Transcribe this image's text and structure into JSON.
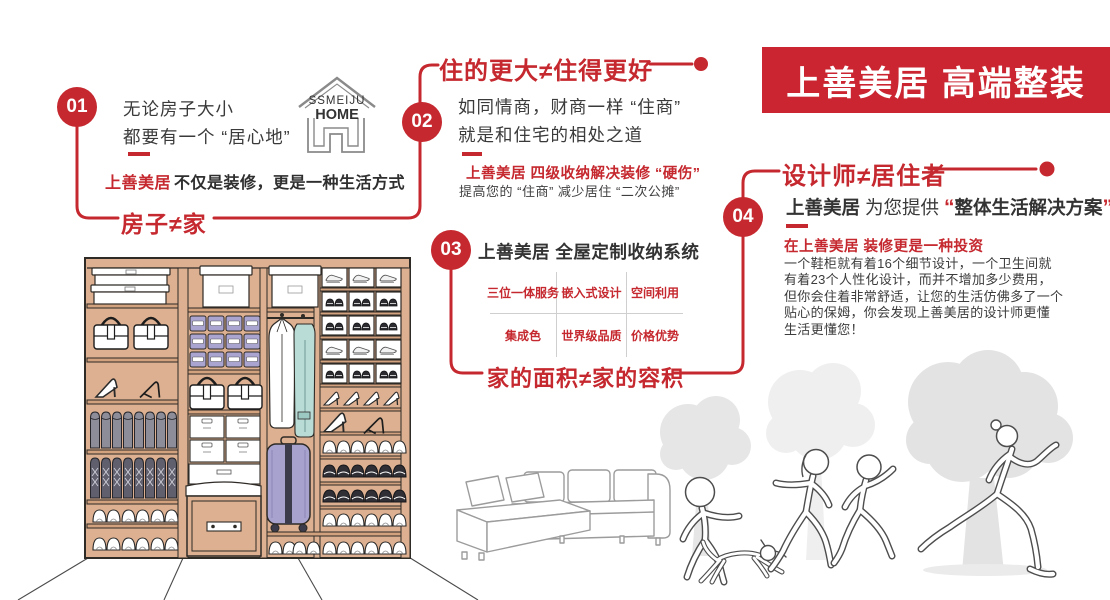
{
  "banner": {
    "title": "上善美居 高端整装"
  },
  "logo": {
    "brand": "SSMEIJU",
    "home": "HOME"
  },
  "s01": {
    "num": "01",
    "line1": "无论房子大小",
    "line2": "都要有一个 “居心地”",
    "tag_brand": "上善美居",
    "tag_rest": "不仅是装修，更是一种生活方式",
    "keyword": "房子≠家"
  },
  "s02": {
    "num": "02",
    "title": "住的更大≠住得更好",
    "line1": "如同情商，财商一样 “住商”",
    "line2": "就是和住宅的相处之道",
    "highlight": "上善美居 四级收纳解决装修 “硬伤”",
    "sub": "提高您的 “住商” 减少居住 “二次公摊”"
  },
  "s03": {
    "num": "03",
    "title": "上善美居 全屋定制收纳系统",
    "cells": [
      "三位一体服务",
      "嵌入式设计",
      "空间利用",
      "集成色",
      "世界级品质",
      "价格优势"
    ],
    "keyword": "家的面积≠家的容积"
  },
  "s04": {
    "num": "04",
    "title": "设计师≠居住者",
    "brand": "上善美居",
    "mid": "为您提供",
    "quote_open": "“",
    "solution": "整体生活解决方案",
    "quote_close": "”",
    "highlight": "在上善美居 装修更是一种投资",
    "lines": [
      "一个鞋柜就有着16个细节设计，一个卫生间就",
      "有着23个人性化设计，而并不增加多少费用，",
      "但你会住着非常舒适，让您的生活仿佛多了一个",
      "贴心的保姆，你会发现上善美居的设计师更懂",
      "生活更懂您！"
    ]
  },
  "colors": {
    "red": "#c5282e",
    "banner_red": "#ca2530",
    "dark_text": "#3a3a3a",
    "cabinet_tan": "#dcb091",
    "bin_purple": "#aaa4d0",
    "garment_teal": "#b9dcd6",
    "tree_gray": "#e5e5e5"
  }
}
